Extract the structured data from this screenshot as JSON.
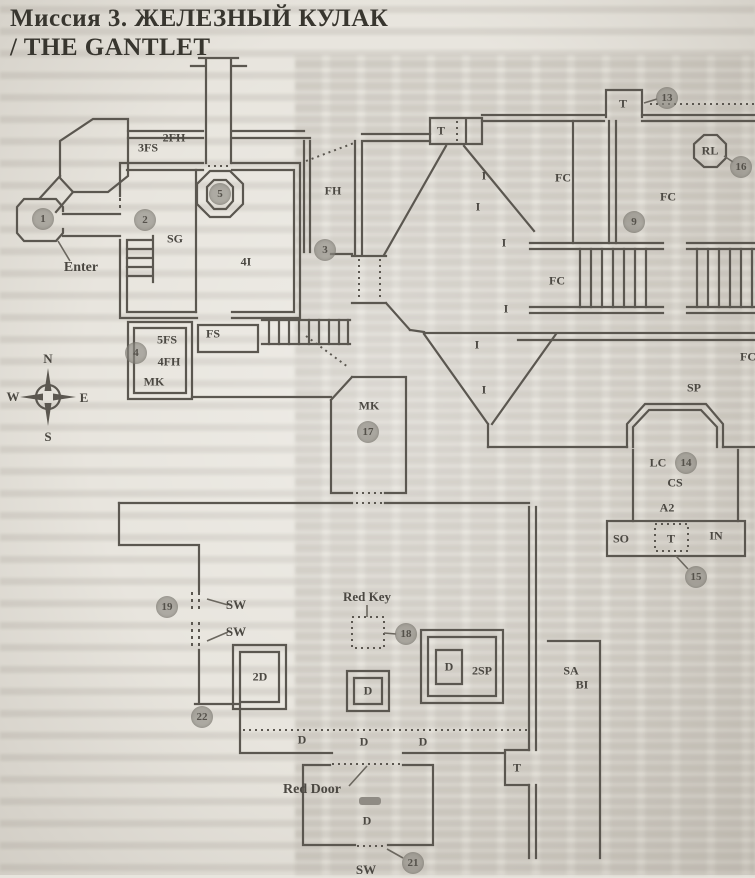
{
  "page": {
    "title_line1": "Миссия 3. ЖЕЛЕЗНЫЙ КУЛАК",
    "title_line2": "/ THE GANTLET"
  },
  "map": {
    "colors": {
      "wall": "#5b5750",
      "marker_fill": "#8e8a82",
      "paper": "#e8e5de"
    },
    "compass": {
      "north": "N",
      "south": "S",
      "east": "E",
      "west": "W"
    },
    "labels": [
      {
        "name": "label-3fs",
        "text": "3FS",
        "x": 148,
        "y": 148
      },
      {
        "name": "label-2fh",
        "text": "2FH",
        "x": 174,
        "y": 138
      },
      {
        "name": "label-fh",
        "text": "FH",
        "x": 333,
        "y": 191
      },
      {
        "name": "label-sg",
        "text": "SG",
        "x": 175,
        "y": 239
      },
      {
        "name": "label-4i",
        "text": "4I",
        "x": 246,
        "y": 262
      },
      {
        "name": "label-enter",
        "text": "Enter",
        "x": 81,
        "y": 268,
        "fs": 14
      },
      {
        "name": "label-5fs",
        "text": "5FS",
        "x": 167,
        "y": 340
      },
      {
        "name": "label-4fh",
        "text": "4FH",
        "x": 169,
        "y": 362
      },
      {
        "name": "label-mk-left",
        "text": "MK",
        "x": 154,
        "y": 382
      },
      {
        "name": "label-fs",
        "text": "FS",
        "x": 213,
        "y": 334
      },
      {
        "name": "compass-n",
        "text": "N",
        "x": 48,
        "y": 359,
        "fs": 13
      },
      {
        "name": "compass-w",
        "text": "W",
        "x": 13,
        "y": 397,
        "fs": 13
      },
      {
        "name": "compass-e",
        "text": "E",
        "x": 84,
        "y": 398,
        "fs": 13
      },
      {
        "name": "compass-s",
        "text": "S",
        "x": 48,
        "y": 437,
        "fs": 13
      },
      {
        "name": "label-t-1",
        "text": "T",
        "x": 441,
        "y": 131
      },
      {
        "name": "label-t-2",
        "text": "T",
        "x": 623,
        "y": 104
      },
      {
        "name": "label-rl",
        "text": "RL",
        "x": 710,
        "y": 151
      },
      {
        "name": "label-fc-1",
        "text": "FC",
        "x": 563,
        "y": 178
      },
      {
        "name": "label-fc-2",
        "text": "FC",
        "x": 668,
        "y": 197
      },
      {
        "name": "label-fc-3",
        "text": "FC",
        "x": 557,
        "y": 281
      },
      {
        "name": "label-fc-4",
        "text": "FC",
        "x": 748,
        "y": 357
      },
      {
        "name": "label-i-1",
        "text": "I",
        "x": 484,
        "y": 176
      },
      {
        "name": "label-i-2",
        "text": "I",
        "x": 478,
        "y": 207
      },
      {
        "name": "label-i-3",
        "text": "I",
        "x": 504,
        "y": 243
      },
      {
        "name": "label-i-4",
        "text": "I",
        "x": 506,
        "y": 309
      },
      {
        "name": "label-i-5",
        "text": "I",
        "x": 477,
        "y": 345
      },
      {
        "name": "label-i-6",
        "text": "I",
        "x": 484,
        "y": 390
      },
      {
        "name": "label-mk-center",
        "text": "MK",
        "x": 369,
        "y": 406
      },
      {
        "name": "label-sp",
        "text": "SP",
        "x": 694,
        "y": 388
      },
      {
        "name": "label-lc",
        "text": "LC",
        "x": 658,
        "y": 463
      },
      {
        "name": "label-cs",
        "text": "CS",
        "x": 675,
        "y": 483
      },
      {
        "name": "label-a2",
        "text": "A2",
        "x": 667,
        "y": 508
      },
      {
        "name": "label-so",
        "text": "SO",
        "x": 621,
        "y": 539
      },
      {
        "name": "label-t-3",
        "text": "T",
        "x": 671,
        "y": 539
      },
      {
        "name": "label-in",
        "text": "IN",
        "x": 716,
        "y": 536
      },
      {
        "name": "label-sa",
        "text": "SA",
        "x": 571,
        "y": 671
      },
      {
        "name": "label-bi",
        "text": "BI",
        "x": 582,
        "y": 685
      },
      {
        "name": "label-sw-1",
        "text": "SW",
        "x": 236,
        "y": 605,
        "fs": 13
      },
      {
        "name": "label-sw-2",
        "text": "SW",
        "x": 236,
        "y": 632,
        "fs": 13
      },
      {
        "name": "label-red-key",
        "text": "Red Key",
        "x": 367,
        "y": 597,
        "fs": 13
      },
      {
        "name": "label-2d",
        "text": "2D",
        "x": 260,
        "y": 677
      },
      {
        "name": "label-d-1",
        "text": "D",
        "x": 368,
        "y": 691
      },
      {
        "name": "label-d-2",
        "text": "D",
        "x": 302,
        "y": 740
      },
      {
        "name": "label-d-3",
        "text": "D",
        "x": 364,
        "y": 742
      },
      {
        "name": "label-d-4",
        "text": "D",
        "x": 423,
        "y": 742
      },
      {
        "name": "label-d-5",
        "text": "D",
        "x": 449,
        "y": 667
      },
      {
        "name": "label-2sp",
        "text": "2SP",
        "x": 482,
        "y": 671
      },
      {
        "name": "label-t-4",
        "text": "T",
        "x": 517,
        "y": 768
      },
      {
        "name": "label-red-door",
        "text": "Red Door",
        "x": 312,
        "y": 790,
        "fs": 14
      },
      {
        "name": "label-d-6",
        "text": "D",
        "x": 367,
        "y": 821
      },
      {
        "name": "label-sw-3",
        "text": "SW",
        "x": 366,
        "y": 870,
        "fs": 13
      }
    ],
    "markers": [
      {
        "n": "1",
        "x": 43,
        "y": 219
      },
      {
        "n": "2",
        "x": 145,
        "y": 220
      },
      {
        "n": "3",
        "x": 325,
        "y": 250
      },
      {
        "n": "4",
        "x": 136,
        "y": 353
      },
      {
        "n": "5",
        "x": 220,
        "y": 194
      },
      {
        "n": "9",
        "x": 634,
        "y": 222
      },
      {
        "n": "13",
        "x": 667,
        "y": 98
      },
      {
        "n": "14",
        "x": 686,
        "y": 463
      },
      {
        "n": "15",
        "x": 696,
        "y": 577
      },
      {
        "n": "16",
        "x": 741,
        "y": 167
      },
      {
        "n": "17",
        "x": 368,
        "y": 432
      },
      {
        "n": "18",
        "x": 406,
        "y": 634
      },
      {
        "n": "19",
        "x": 167,
        "y": 607
      },
      {
        "n": "21",
        "x": 413,
        "y": 863
      },
      {
        "n": "22",
        "x": 202,
        "y": 717
      }
    ]
  }
}
